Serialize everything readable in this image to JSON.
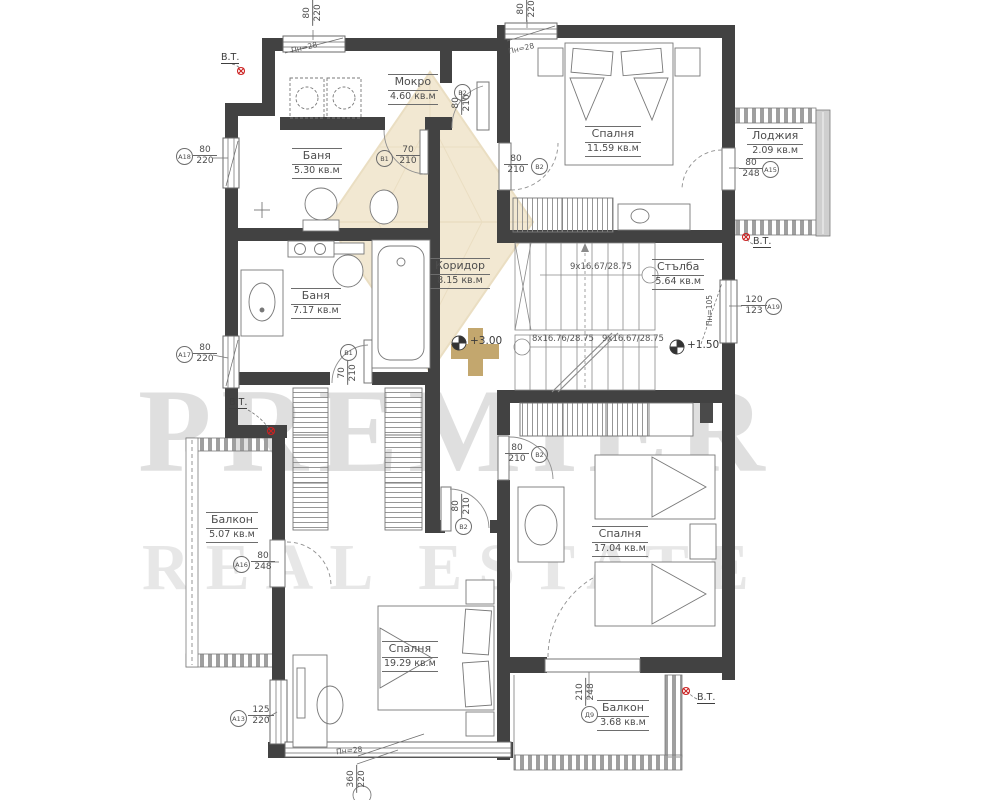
{
  "watermark": {
    "line1": "PREMIER",
    "line2": "REAL ESTATE",
    "brand_gold": "#c9a54e"
  },
  "rooms": [
    {
      "name": "Мокро",
      "area": "4.60 кв.м"
    },
    {
      "name": "Спалня",
      "area": "11.59 кв.м"
    },
    {
      "name": "Лоджия",
      "area": "2.09 кв.м"
    },
    {
      "name": "Баня",
      "area": "5.30 кв.м"
    },
    {
      "name": "Баня",
      "area": "7.17 кв.м"
    },
    {
      "name": "Коридор",
      "area": "8.15 кв.м"
    },
    {
      "name": "Стълба",
      "area": "5.64 кв.м"
    },
    {
      "name": "Балкон",
      "area": "5.07 кв.м"
    },
    {
      "name": "Спалня",
      "area": "17.04 кв.м"
    },
    {
      "name": "Спалня",
      "area": "19.29 кв.м"
    },
    {
      "name": "Балкон",
      "area": "3.68 кв.м"
    }
  ],
  "openings": {
    "win_top_left": {
      "t": "80",
      "b": "220"
    },
    "win_top_right": {
      "t": "80",
      "b": "220"
    },
    "win_a18": {
      "t": "80",
      "b": "220",
      "tag": "А18"
    },
    "win_a17": {
      "t": "80",
      "b": "220",
      "tag": "А17"
    },
    "win_a13": {
      "t": "125",
      "b": "220",
      "tag": "А13"
    },
    "win_a19": {
      "t": "120",
      "b": "123",
      "tag": "А19"
    },
    "win_bottom": {
      "t": "360",
      "b": "220"
    },
    "door_loggia": {
      "t": "80",
      "b": "248",
      "tag": "А15"
    },
    "door_balcony_left": {
      "t": "80",
      "b": "248",
      "tag": "А16"
    },
    "door_balcony_bottom": {
      "t": "210",
      "b": "248",
      "tag": "Д9"
    },
    "door_mokro": {
      "t": "80",
      "b": "210",
      "tag": "В2"
    },
    "door_bedroom_top": {
      "t": "80",
      "b": "210",
      "tag": "В2"
    },
    "door_bath_1": {
      "t": "70",
      "b": "210",
      "tag": "В1"
    },
    "door_bath_2": {
      "t": "70",
      "b": "210",
      "tag": "В1"
    },
    "door_bedroom_right": {
      "t": "80",
      "b": "210",
      "tag": "В2"
    },
    "door_bedroom_bottom": {
      "t": "80",
      "b": "210",
      "tag": "В2"
    }
  },
  "annotations": {
    "pn_28": "Пн=28",
    "pn_105": "Пн=105",
    "stair_run_top": "9x16.67/28.75",
    "stair_run_left": "8x16.76/28.75",
    "stair_run_right": "9x16.67/28.75",
    "level_corridor": "+3.00",
    "level_stair": "+1.50",
    "vt": "В.Т."
  }
}
